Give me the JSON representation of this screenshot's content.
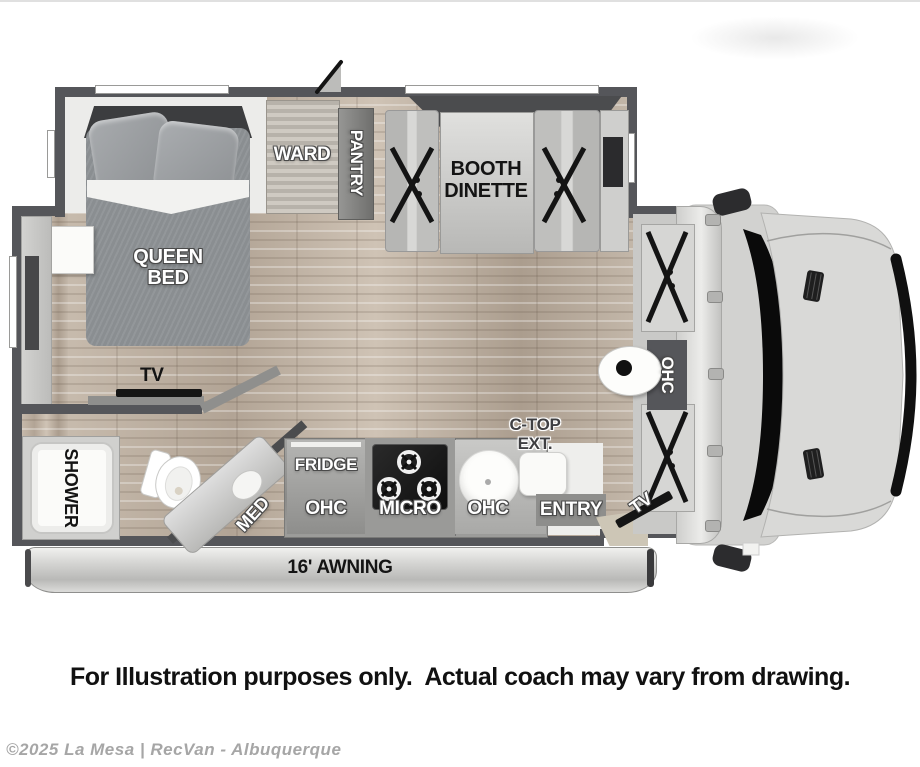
{
  "colors": {
    "wall": "#55565a",
    "floor": "#bdb0a2",
    "bed": "#8a8e91",
    "cab_body": "#d6d6d4",
    "label_white": "#ffffff",
    "label_black": "#141414",
    "awning": "#d9d9d7"
  },
  "rooms": {
    "queen_bed": {
      "line1": "QUEEN",
      "line2": "BED"
    },
    "ward": "WARD",
    "pantry": "PANTRY",
    "booth_dinette": {
      "line1": "BOOTH",
      "line2": "DINETTE"
    },
    "bedroom_tv": "TV",
    "shower": "SHOWER",
    "med": "MED",
    "fridge": "FRIDGE",
    "ohc_kitchen_left": "OHC",
    "micro": "MICRO",
    "ohc_kitchen_right": "OHC",
    "entry": "ENTRY",
    "ctop_ext": {
      "line1": "C-TOP",
      "line2": "EXT."
    },
    "ohc_cabover": "OHC",
    "cab_tv": "TV",
    "awning": "16' AWNING"
  },
  "icons": {
    "toilet": "css-svg-shape",
    "sink": "circle",
    "cooktop_burners": "ring-with-cross",
    "pedestal_table": "oval-with-dot",
    "roof_antenna": "triangle-flap"
  },
  "footer": {
    "caption": "For Illustration purposes only.  Actual coach may vary from drawing.",
    "watermark": "©2025 La Mesa | RecVan - Albuquerque"
  }
}
